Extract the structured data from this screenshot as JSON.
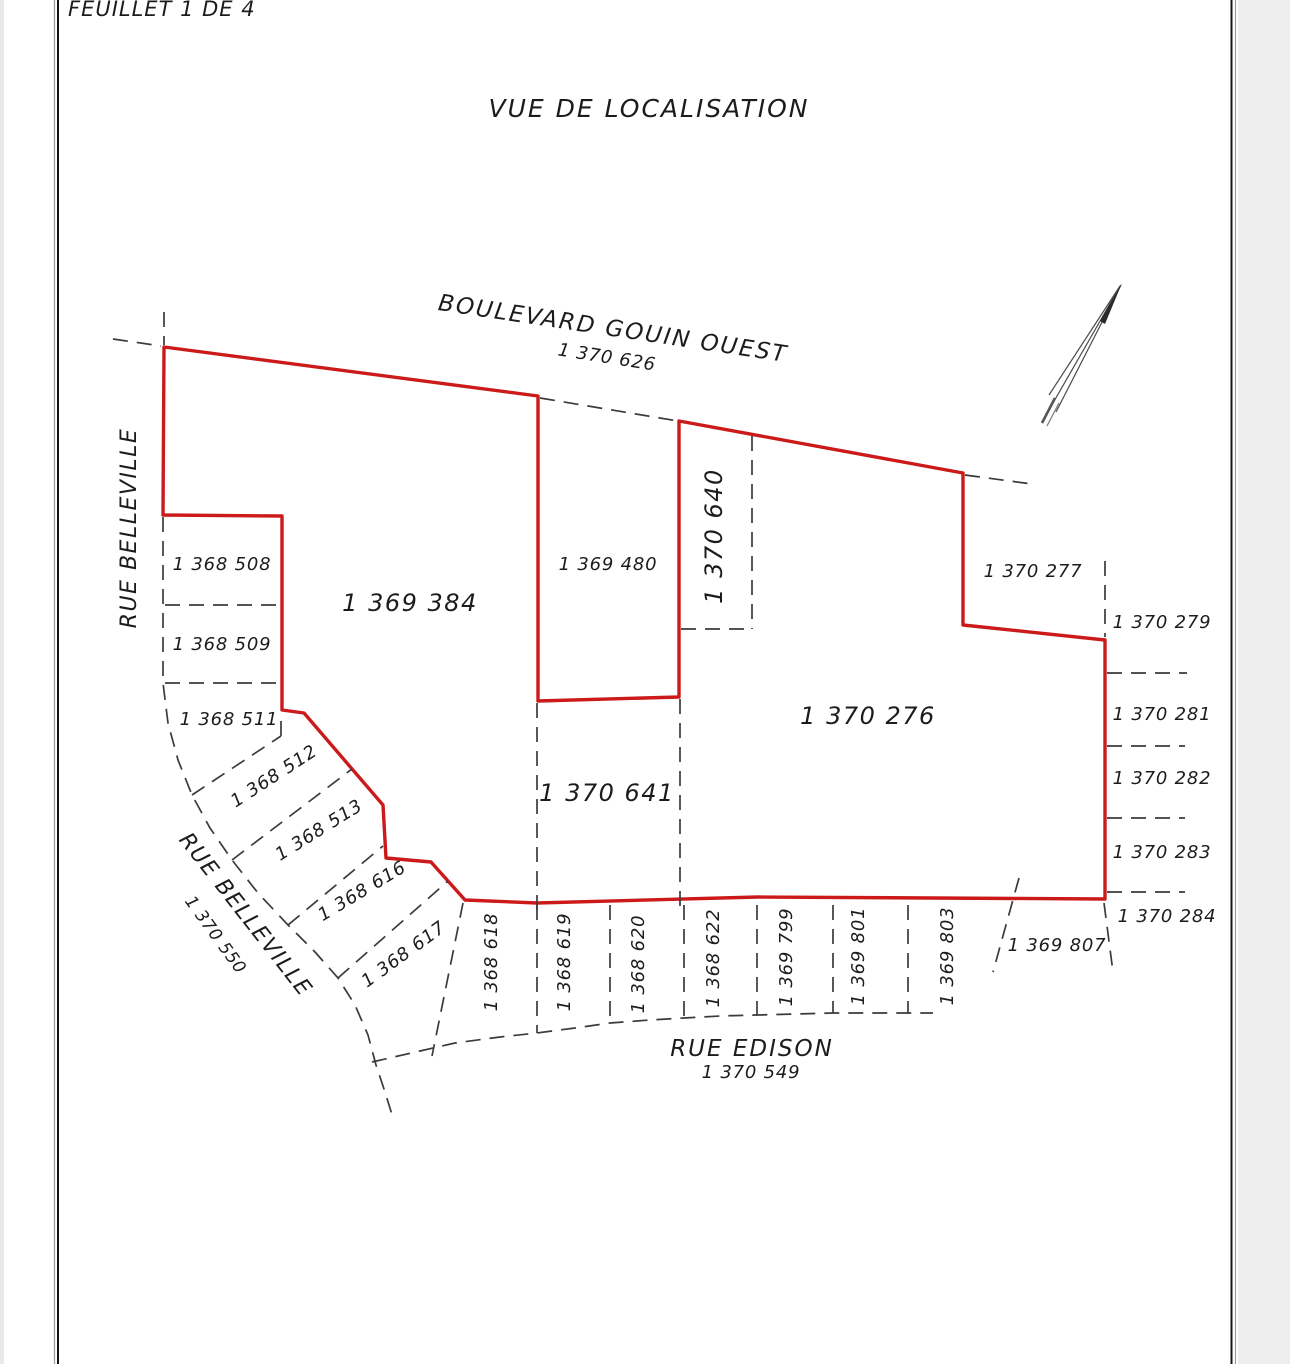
{
  "page": {
    "sheet": "FEUILLET 1 DE 4",
    "title": "VUE DE LOCALISATION"
  },
  "streets": {
    "gouin_name": "BOULEVARD GOUIN OUEST",
    "gouin_lot": "1 370 626",
    "belleville_name": "RUE BELLEVILLE",
    "belleville_lot": "1 370 550",
    "edison_name": "RUE EDISON",
    "edison_lot": "1 370 549"
  },
  "lots": {
    "384": "1 369 384",
    "480": "1 369 480",
    "508": "1 368 508",
    "509": "1 368 509",
    "511": "1 368 511",
    "512": "1 368 512",
    "513": "1 368 513",
    "616": "1 368 616",
    "617": "1 368 617",
    "618": "1 368 618",
    "619": "1 368 619",
    "620": "1 368 620",
    "622": "1 368 622",
    "640": "1 370 640",
    "641": "1 370 641",
    "276": "1 370 276",
    "277": "1 370 277",
    "279": "1 370 279",
    "281": "1 370 281",
    "282": "1 370 282",
    "283": "1 370 283",
    "284": "1 370 284",
    "799": "1 369 799",
    "801": "1 369 801",
    "803": "1 369 803",
    "807": "1 369 807"
  },
  "colors": {
    "boundary_red": "#cc1a1a",
    "line_dark": "#3b3b3b"
  }
}
